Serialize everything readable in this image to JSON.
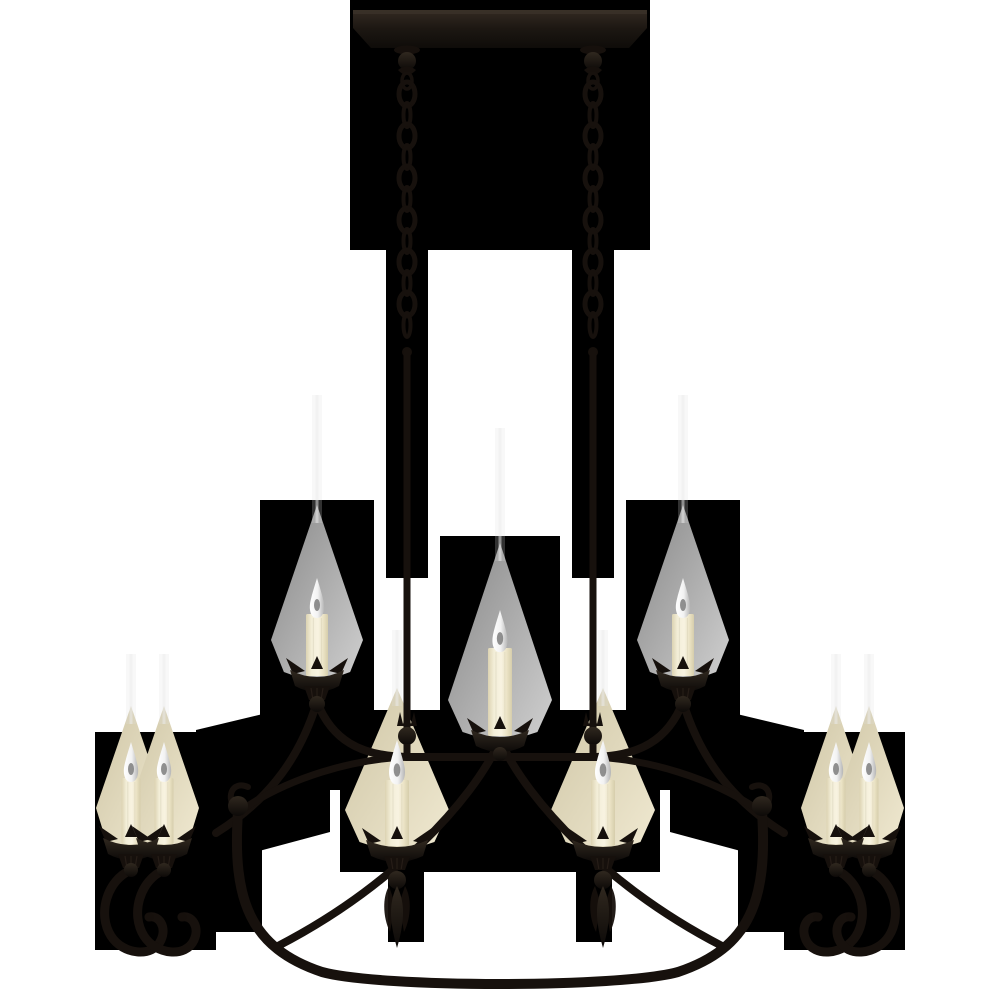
{
  "scene": {
    "type": "product-photo",
    "subject": "nine-light blackened wrought-iron linear chandelier with cream candle covers, hung on two chains from a rectangular ceiling canopy",
    "background_color": "#ffffff",
    "matte_color": "#000000",
    "light_count": 9
  },
  "palette": {
    "matte": "#000000",
    "iron_stroke": "#17110d",
    "iron_fill": "#16100c",
    "iron_hi": "#3a3128",
    "wax_edge": "#dcd3b2",
    "wax_mid": "#f8f3e1",
    "wax_shadow": "#d6cdab",
    "flame_core": "#757575",
    "flame_light": "#ffffff",
    "flame_shade": "#b5b5b5",
    "glow_gray_a": "#878787",
    "glow_gray_b": "#d0d0d0",
    "glow_warm_a": "#cfc6a6",
    "glow_warm_b": "#f0e9d1",
    "glow_strip": "#dedede"
  },
  "matte_polygons": [
    [
      [
        350,
        0
      ],
      [
        650,
        0
      ],
      [
        650,
        250
      ],
      [
        350,
        250
      ]
    ],
    [
      [
        386,
        250
      ],
      [
        428,
        250
      ],
      [
        428,
        578
      ],
      [
        386,
        578
      ]
    ],
    [
      [
        572,
        250
      ],
      [
        614,
        250
      ],
      [
        614,
        578
      ],
      [
        572,
        578
      ]
    ],
    [
      [
        260,
        500
      ],
      [
        374,
        500
      ],
      [
        374,
        716
      ],
      [
        430,
        758
      ],
      [
        430,
        790
      ],
      [
        260,
        790
      ]
    ],
    [
      [
        740,
        500
      ],
      [
        626,
        500
      ],
      [
        626,
        716
      ],
      [
        570,
        758
      ],
      [
        570,
        790
      ],
      [
        740,
        790
      ]
    ],
    [
      [
        440,
        536
      ],
      [
        560,
        536
      ],
      [
        560,
        790
      ],
      [
        440,
        790
      ]
    ],
    [
      [
        374,
        710
      ],
      [
        626,
        710
      ],
      [
        626,
        796
      ],
      [
        374,
        796
      ]
    ],
    [
      [
        196,
        730
      ],
      [
        330,
        698
      ],
      [
        330,
        832
      ],
      [
        196,
        868
      ]
    ],
    [
      [
        804,
        730
      ],
      [
        670,
        698
      ],
      [
        670,
        832
      ],
      [
        804,
        868
      ]
    ],
    [
      [
        95,
        732
      ],
      [
        216,
        732
      ],
      [
        216,
        950
      ],
      [
        95,
        950
      ]
    ],
    [
      [
        784,
        732
      ],
      [
        905,
        732
      ],
      [
        905,
        950
      ],
      [
        784,
        950
      ]
    ],
    [
      [
        216,
        795
      ],
      [
        262,
        795
      ],
      [
        262,
        932
      ],
      [
        216,
        932
      ]
    ],
    [
      [
        738,
        795
      ],
      [
        784,
        795
      ],
      [
        784,
        932
      ],
      [
        738,
        932
      ]
    ],
    [
      [
        340,
        728
      ],
      [
        660,
        728
      ],
      [
        660,
        872
      ],
      [
        340,
        872
      ]
    ],
    [
      [
        388,
        872
      ],
      [
        424,
        872
      ],
      [
        424,
        942
      ],
      [
        388,
        942
      ]
    ],
    [
      [
        576,
        872
      ],
      [
        612,
        872
      ],
      [
        612,
        942
      ],
      [
        576,
        942
      ]
    ]
  ],
  "canopy": {
    "path": "M353,10 L647,10 L647,28 L629,48 L371,48 L353,28 Z",
    "x": 353,
    "top_y": 10,
    "width": 294
  },
  "suspension": {
    "xs": [
      407,
      593
    ],
    "chain_top": 88,
    "link_spacing": 21,
    "link_count": 12,
    "rod_top": 350,
    "rod_bottom": 757,
    "collar_spike_y": 712
  },
  "frame": {
    "crossbar": "M407,757 L593,757",
    "arm_inner_left": "M317,702 C332,740 360,756 407,757",
    "arm_inner_right": "M683,702 C668,740 640,756 593,757",
    "arm_outer_left": "M317,702 C301,754 272,798 216,833",
    "arm_outer_right": "M683,702 C699,754 728,798 784,833",
    "bar_ext_left": "M407,757 C352,759 289,778 243,809",
    "bar_ext_right": "M593,757 C648,759 711,778 757,809",
    "diag_left": "M498,744 C472,800 394,886 278,946",
    "diag_right": "M502,744 C528,800 606,886 722,946",
    "ring": "M238,812 C232,900 250,948 322,972 C380,988 620,988 678,972 C750,948 768,900 762,812",
    "ring_hook_left": "M238,812 C224,798 232,780 248,787",
    "ring_hook_right": "M762,812 C776,798 768,780 752,787",
    "scroll_balls": [
      [
        238,
        806
      ],
      [
        762,
        806
      ]
    ]
  },
  "cluster_scrolls": {
    "y": 870,
    "arms": [
      {
        "cx": 131,
        "dir": 1
      },
      {
        "cx": 164,
        "dir": 1
      },
      {
        "cx": 836,
        "dir": -1
      },
      {
        "cx": 869,
        "dir": -1
      }
    ]
  },
  "candles": [
    {
      "id": "upper-left",
      "cx": 317,
      "flame_tip": 578,
      "body_top": 614,
      "cup_y": 668,
      "body_w": 22,
      "cup_w": 54,
      "glow": "gray",
      "glow_apex": 505,
      "glow_half": 46,
      "strip_h": 110,
      "ball_r": 8,
      "ball_dy": 36,
      "has_skirt": true,
      "has_drop": false
    },
    {
      "id": "upper-center",
      "cx": 500,
      "flame_tip": 610,
      "body_top": 648,
      "cup_y": 728,
      "body_w": 24,
      "cup_w": 58,
      "glow": "gray",
      "glow_apex": 543,
      "glow_half": 52,
      "strip_h": 115,
      "ball_r": 7,
      "ball_dy": 26,
      "has_skirt": false,
      "has_drop": false
    },
    {
      "id": "upper-right",
      "cx": 683,
      "flame_tip": 578,
      "body_top": 614,
      "cup_y": 668,
      "body_w": 22,
      "cup_w": 54,
      "glow": "gray",
      "glow_apex": 505,
      "glow_half": 46,
      "strip_h": 110,
      "ball_r": 8,
      "ball_dy": 36,
      "has_skirt": true,
      "has_drop": false
    },
    {
      "id": "center-left",
      "cx": 397,
      "flame_tip": 740,
      "body_top": 780,
      "cup_y": 838,
      "body_w": 24,
      "cup_w": 62,
      "glow": "warm",
      "glow_apex": 688,
      "glow_half": 52,
      "strip_h": 58,
      "ball_r": 9,
      "ball_dy": 42,
      "has_skirt": true,
      "has_drop": true
    },
    {
      "id": "center-right",
      "cx": 603,
      "flame_tip": 740,
      "body_top": 780,
      "cup_y": 838,
      "body_w": 24,
      "cup_w": 62,
      "glow": "warm",
      "glow_apex": 688,
      "glow_half": 52,
      "strip_h": 58,
      "ball_r": 9,
      "ball_dy": 42,
      "has_skirt": true,
      "has_drop": true
    },
    {
      "id": "left-pair-outer",
      "cx": 131,
      "flame_tip": 742,
      "body_top": 778,
      "cup_y": 836,
      "body_w": 19,
      "cup_w": 56,
      "glow": "warm",
      "glow_apex": 706,
      "glow_half": 35,
      "strip_h": 52,
      "ball_r": 7,
      "ball_dy": 34,
      "has_skirt": true,
      "has_drop": false
    },
    {
      "id": "left-pair-inner",
      "cx": 164,
      "flame_tip": 742,
      "body_top": 778,
      "cup_y": 836,
      "body_w": 19,
      "cup_w": 56,
      "glow": "warm",
      "glow_apex": 706,
      "glow_half": 35,
      "strip_h": 52,
      "ball_r": 7,
      "ball_dy": 34,
      "has_skirt": true,
      "has_drop": false
    },
    {
      "id": "right-pair-inner",
      "cx": 836,
      "flame_tip": 742,
      "body_top": 778,
      "cup_y": 836,
      "body_w": 19,
      "cup_w": 56,
      "glow": "warm",
      "glow_apex": 706,
      "glow_half": 35,
      "strip_h": 52,
      "ball_r": 7,
      "ball_dy": 34,
      "has_skirt": true,
      "has_drop": false
    },
    {
      "id": "right-pair-outer",
      "cx": 869,
      "flame_tip": 742,
      "body_top": 778,
      "cup_y": 836,
      "body_w": 19,
      "cup_w": 56,
      "glow": "warm",
      "glow_apex": 706,
      "glow_half": 35,
      "strip_h": 52,
      "ball_r": 7,
      "ball_dy": 34,
      "has_skirt": true,
      "has_drop": false
    }
  ],
  "drops": [
    {
      "cx": 397,
      "top": 886,
      "bottom": 948
    },
    {
      "cx": 603,
      "top": 886,
      "bottom": 948
    }
  ]
}
